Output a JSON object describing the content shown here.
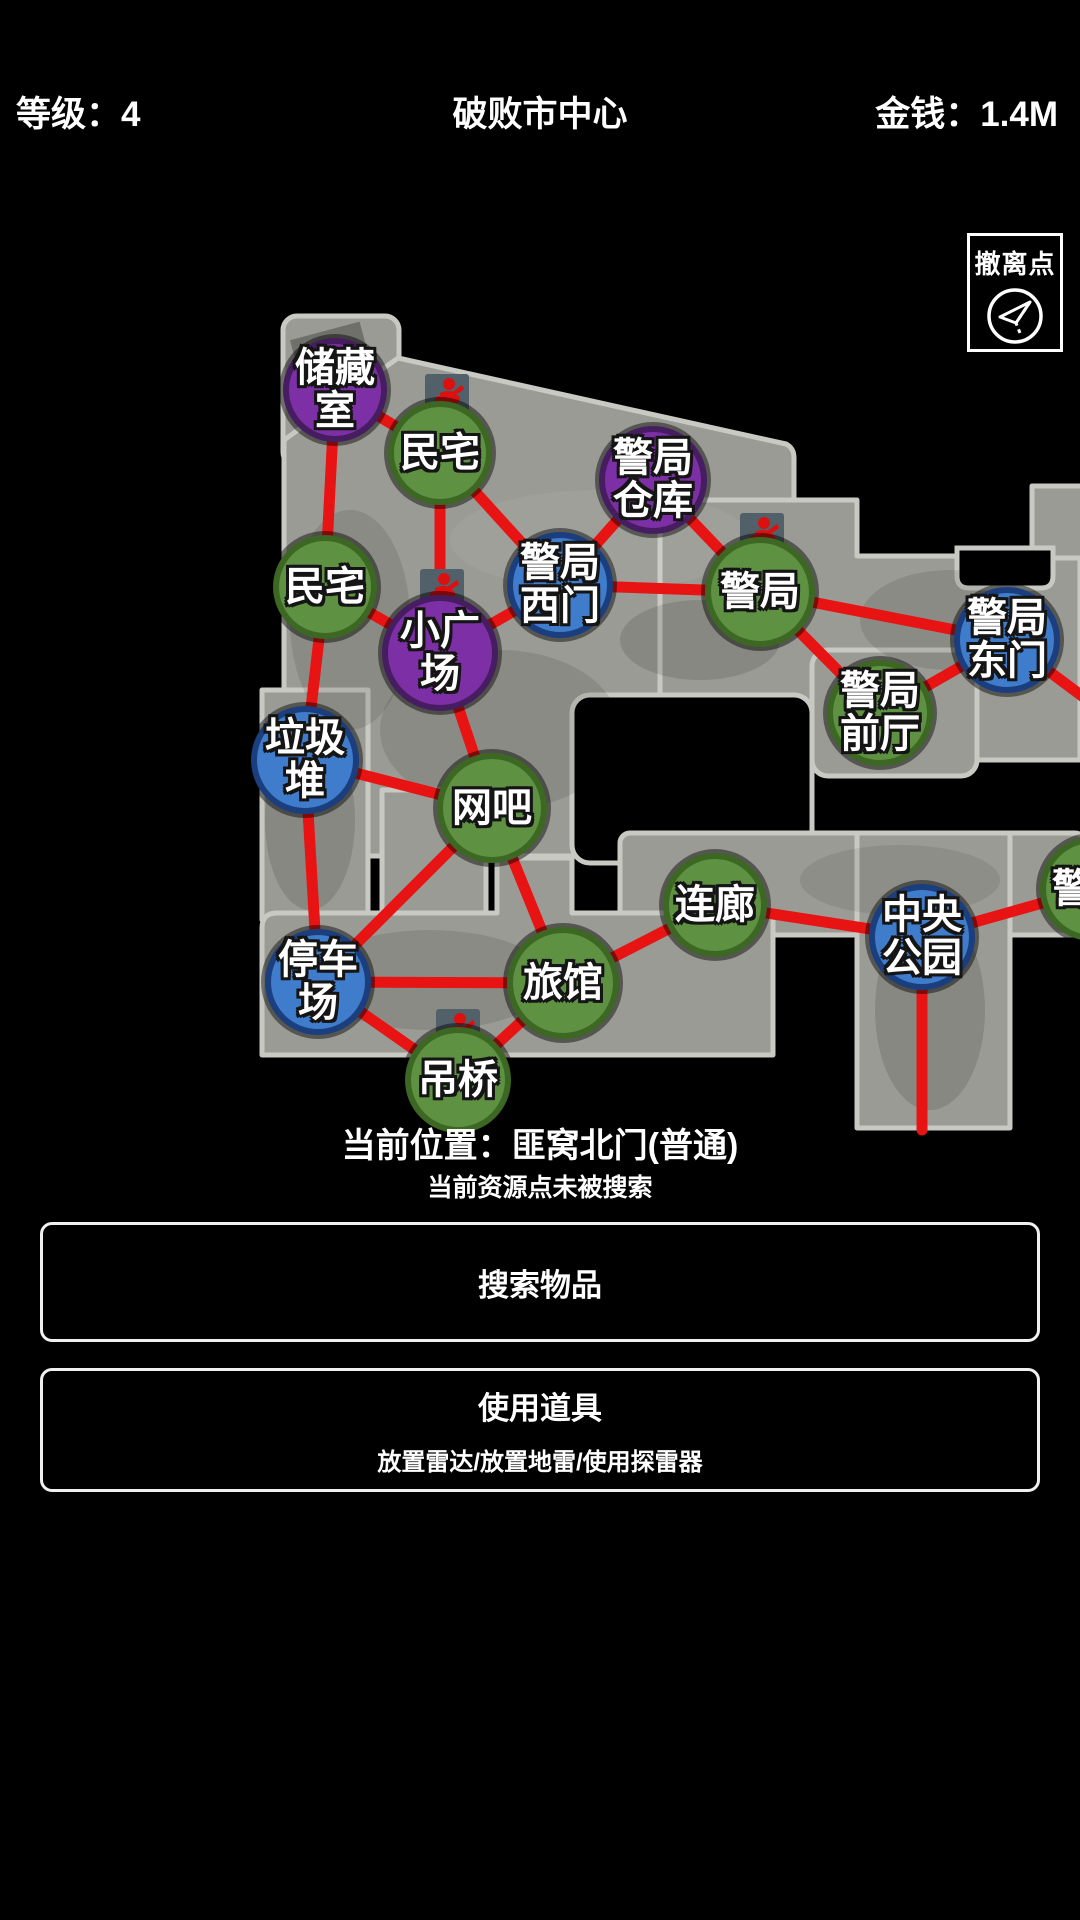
{
  "header": {
    "level": "等级：4",
    "title": "破败市中心",
    "money": "金钱：1.4M"
  },
  "evac": {
    "label": "撤离点"
  },
  "status": {
    "location": "当前位置：匪窝北门(普通)",
    "hint": "当前资源点未被搜索"
  },
  "buttons": {
    "search": "搜索物品",
    "use_title": "使用道具",
    "use_subtitle": "放置雷达/放置地雷/使用探雷器"
  },
  "colors": {
    "edge": "#e81313",
    "green": "#5e9142",
    "green_border": "#3c6823",
    "purple": "#7d2fa6",
    "purple_border": "#471d61",
    "blue": "#3f7ccc",
    "blue_border": "#1b3f7e",
    "map_ground": "#9b9b95",
    "map_stroke": "#c9c9c3",
    "icon_bg": "#52606a",
    "icon_glyph": "#dd1010"
  },
  "map": {
    "nodes": [
      {
        "id": "chucang",
        "label": "储藏室",
        "color": "purple",
        "x": 335,
        "y": 390,
        "d": 104
      },
      {
        "id": "minzhai1",
        "label": "民宅",
        "color": "green",
        "x": 440,
        "y": 453,
        "d": 104
      },
      {
        "id": "cangku",
        "label": "警局仓库",
        "color": "purple",
        "x": 653,
        "y": 480,
        "d": 108
      },
      {
        "id": "ximen",
        "label": "警局西门",
        "color": "blue",
        "x": 560,
        "y": 585,
        "d": 106
      },
      {
        "id": "jingju",
        "label": "警局",
        "color": "green",
        "x": 760,
        "y": 592,
        "d": 110
      },
      {
        "id": "dongmen",
        "label": "警局东门",
        "color": "blue",
        "x": 1007,
        "y": 640,
        "d": 106
      },
      {
        "id": "minzhai2",
        "label": "民宅",
        "color": "green",
        "x": 325,
        "y": 587,
        "d": 104
      },
      {
        "id": "guangchang",
        "label": "小广场",
        "color": "purple",
        "x": 440,
        "y": 653,
        "d": 116
      },
      {
        "id": "qianting",
        "label": "警局前厅",
        "color": "green",
        "x": 880,
        "y": 713,
        "d": 106
      },
      {
        "id": "laji",
        "label": "垃圾堆",
        "color": "blue",
        "x": 305,
        "y": 760,
        "d": 108
      },
      {
        "id": "wangba",
        "label": "网吧",
        "color": "green",
        "x": 492,
        "y": 808,
        "d": 110
      },
      {
        "id": "tingche",
        "label": "停车场",
        "color": "blue",
        "x": 318,
        "y": 982,
        "d": 106
      },
      {
        "id": "lvguan",
        "label": "旅馆",
        "color": "green",
        "x": 563,
        "y": 983,
        "d": 112
      },
      {
        "id": "diaoqiao",
        "label": "吊桥",
        "color": "green",
        "x": 458,
        "y": 1080,
        "d": 106
      },
      {
        "id": "lianlang",
        "label": "连廊",
        "color": "green",
        "x": 715,
        "y": 905,
        "d": 104
      },
      {
        "id": "gongyuan",
        "label": "中央公园",
        "color": "blue",
        "x": 922,
        "y": 937,
        "d": 106
      },
      {
        "id": "dongbu",
        "label": "警局",
        "color": "green",
        "x": 1092,
        "y": 889,
        "d": 104
      },
      {
        "id": "exit_east",
        "label": "",
        "x": 1098,
        "y": 708,
        "hidden": true
      },
      {
        "id": "exit_south",
        "label": "",
        "x": 922,
        "y": 1130,
        "hidden": true
      }
    ],
    "edges": [
      [
        "chucang",
        "minzhai1"
      ],
      [
        "chucang",
        "minzhai2"
      ],
      [
        "minzhai1",
        "ximen"
      ],
      [
        "minzhai1",
        "guangchang"
      ],
      [
        "minzhai2",
        "guangchang"
      ],
      [
        "minzhai2",
        "laji"
      ],
      [
        "ximen",
        "guangchang"
      ],
      [
        "ximen",
        "cangku"
      ],
      [
        "ximen",
        "jingju"
      ],
      [
        "cangku",
        "jingju"
      ],
      [
        "jingju",
        "dongmen"
      ],
      [
        "jingju",
        "qianting"
      ],
      [
        "dongmen",
        "qianting"
      ],
      [
        "dongmen",
        "exit_east"
      ],
      [
        "guangchang",
        "wangba"
      ],
      [
        "laji",
        "wangba"
      ],
      [
        "laji",
        "tingche"
      ],
      [
        "wangba",
        "tingche"
      ],
      [
        "wangba",
        "lvguan"
      ],
      [
        "tingche",
        "lvguan"
      ],
      [
        "tingche",
        "diaoqiao"
      ],
      [
        "lvguan",
        "diaoqiao"
      ],
      [
        "lvguan",
        "lianlang"
      ],
      [
        "lianlang",
        "gongyuan"
      ],
      [
        "gongyuan",
        "dongbu"
      ],
      [
        "gongyuan",
        "exit_south"
      ]
    ],
    "icons": [
      {
        "name": "enemy-marker",
        "x": 447,
        "y": 395
      },
      {
        "name": "enemy-marker",
        "x": 442,
        "y": 590
      },
      {
        "name": "enemy-marker",
        "x": 762,
        "y": 534
      },
      {
        "name": "enemy-marker",
        "x": 458,
        "y": 1030
      }
    ]
  }
}
